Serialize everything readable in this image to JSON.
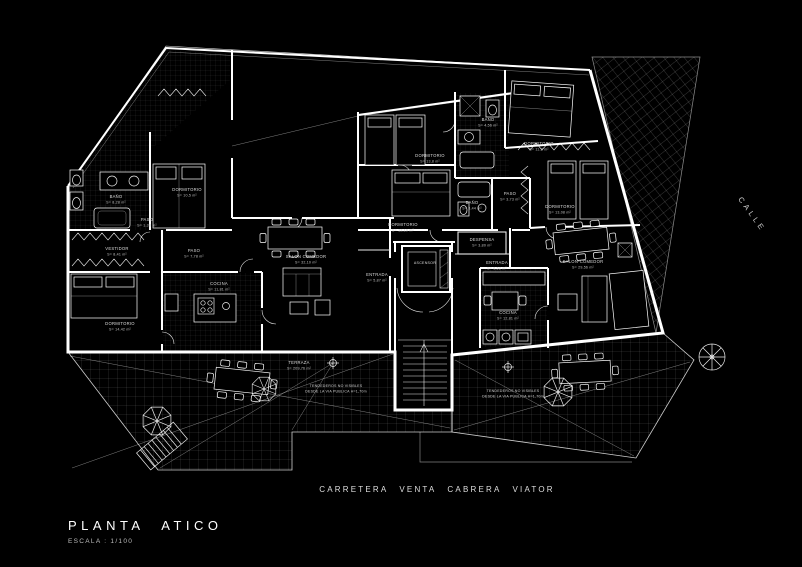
{
  "title": {
    "main": "PLANTA ATICO",
    "scale": "ESCALA : 1/100"
  },
  "streets": {
    "bottom": "CARRETERA VENTA CABRERA VIATOR",
    "right": "CALLE"
  },
  "colors": {
    "background": "#000000",
    "line": "#ffffff"
  },
  "notes": {
    "tendederos_line1": "TENDEDEROS NO VISIBLES",
    "tendederos_line2": "DESDE LA VIA PUBLICA H=1,70m"
  },
  "core": {
    "elevator": "ASCENSOR"
  },
  "rooms": {
    "bano1": {
      "name": "BAÑO",
      "area": "S= 8,28 m²"
    },
    "dorm1": {
      "name": "DORMITORIO",
      "area": "S= 10,5 m²"
    },
    "paso1": {
      "name": "PASO",
      "area": "S= 1,38 m²"
    },
    "vestidor": {
      "name": "VESTIDOR",
      "area": "S= 8,41 m²"
    },
    "paso2": {
      "name": "PASO",
      "area": "S= 7,78 m²"
    },
    "dorm2": {
      "name": "DORMITORIO",
      "area": "S= 14,42 m²"
    },
    "cocina1": {
      "name": "COCINA",
      "area": "S= 11,81 m²"
    },
    "salon1": {
      "name": "SALON COMEDOR",
      "area": "S= 32,10 m²"
    },
    "dorm3": {
      "name": "DORMITORIO",
      "area": "S= 13,8 m²"
    },
    "dorm4": {
      "name": "DORMITORIO",
      "area": "S= 12,10 m²"
    },
    "bano2": {
      "name": "BAÑO",
      "area": "S= 4,56 m²"
    },
    "bano3": {
      "name": "BAÑO",
      "area": "S= 3,44 m²"
    },
    "paso3": {
      "name": "PASO",
      "area": "S= 3,73 m²"
    },
    "dorm5": {
      "name": "DORMITORIO",
      "area": "S= 11,2 m²"
    },
    "dorm6": {
      "name": "DORMITORIO",
      "area": "S= 13,08 m²"
    },
    "salon2": {
      "name": "SALON-COMEDOR",
      "area": "S= 29,56 m²"
    },
    "cocina2": {
      "name": "COCINA",
      "area": "S= 12,81 m²"
    },
    "entrada1": {
      "name": "ENTRADA",
      "area": "S= 5,87 m²"
    },
    "entrada2": {
      "name": "ENTRADA",
      "area": "S= 6,52 m²"
    },
    "despensa": {
      "name": "DESPENSA",
      "area": "S= 3,80 m²"
    },
    "terraza": {
      "name": "TERRAZA",
      "area": "S= 209,76 m²"
    }
  }
}
